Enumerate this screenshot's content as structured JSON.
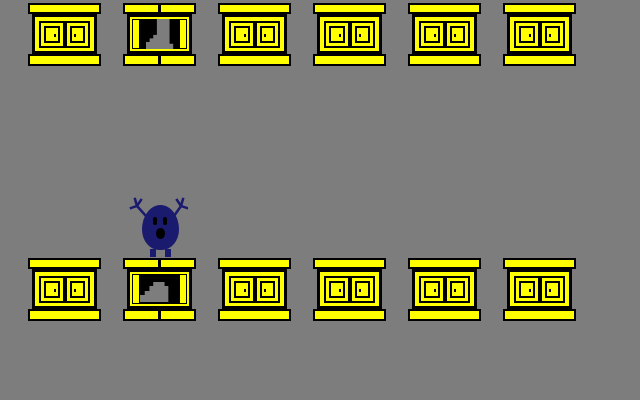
{
  "scene": {
    "width": 640,
    "height": 400,
    "background_color": "#7d7d7d",
    "colors": {
      "cabinet_yellow": "#ffff00",
      "outline_black": "#000000",
      "interior_black": "#000000",
      "item_gray": "#7d7d7d",
      "character_navy": "#1a1a6e",
      "character_face_black": "#000000"
    },
    "cabinet_size": {
      "width": 73,
      "height": 63
    },
    "rows": [
      {
        "name": "top-cabinet-row",
        "y": 3,
        "cabinets": [
          {
            "x": 28,
            "state": "closed",
            "item": null
          },
          {
            "x": 123,
            "state": "open",
            "item": "boot"
          },
          {
            "x": 218,
            "state": "closed",
            "item": null
          },
          {
            "x": 313,
            "state": "closed",
            "item": null
          },
          {
            "x": 408,
            "state": "closed",
            "item": null
          },
          {
            "x": 503,
            "state": "closed",
            "item": null
          }
        ]
      },
      {
        "name": "bottom-cabinet-row",
        "y": 258,
        "cabinets": [
          {
            "x": 28,
            "state": "closed",
            "item": null
          },
          {
            "x": 123,
            "state": "open",
            "item": "shoe"
          },
          {
            "x": 218,
            "state": "closed",
            "item": null
          },
          {
            "x": 313,
            "state": "closed",
            "item": null
          },
          {
            "x": 408,
            "state": "closed",
            "item": null
          },
          {
            "x": 503,
            "state": "closed",
            "item": null
          }
        ]
      }
    ],
    "revealed_items": {
      "top_row": "boot",
      "bottom_row": "shoe"
    },
    "character": {
      "name": "blue-blob",
      "x": 128,
      "y": 196,
      "pose": "arms-raised",
      "standing_on": "bottom row cabinet 2"
    }
  }
}
